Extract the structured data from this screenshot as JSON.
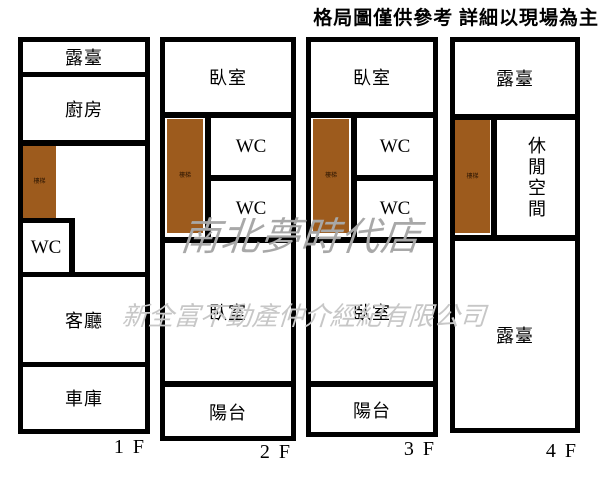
{
  "disclaimer": "格局圖僅供參考 詳細以現場為主",
  "watermarks": {
    "store": "南北夢時代店",
    "company": "新全富不動產仲介經紀有限公司"
  },
  "stairs_label": "樓梯",
  "colors": {
    "wall": "#000000",
    "stairs": "#9d5b1d",
    "watermark_store": "#a8a8a8",
    "watermark_company": "#c7c7c7",
    "background": "#ffffff"
  },
  "floors": [
    {
      "name": "1F",
      "floor_label": "1 F",
      "rooms": {
        "terrace": "露臺",
        "kitchen": "廚房",
        "wc": "WC",
        "living": "客廳",
        "garage": "車庫"
      }
    },
    {
      "name": "2F",
      "floor_label": "2 F",
      "rooms": {
        "bedroom_top": "臥室",
        "wc_upper": "WC",
        "wc_lower": "WC",
        "bedroom_bottom": "臥室",
        "balcony": "陽台"
      }
    },
    {
      "name": "3F",
      "floor_label": "3 F",
      "rooms": {
        "bedroom_top": "臥室",
        "wc_upper": "WC",
        "wc_lower": "WC",
        "bedroom_bottom": "臥室",
        "balcony": "陽台"
      }
    },
    {
      "name": "4F",
      "floor_label": "4 F",
      "rooms": {
        "terrace_top": "露臺",
        "leisure": "休閒空間",
        "terrace_bottom": "露臺"
      }
    }
  ]
}
